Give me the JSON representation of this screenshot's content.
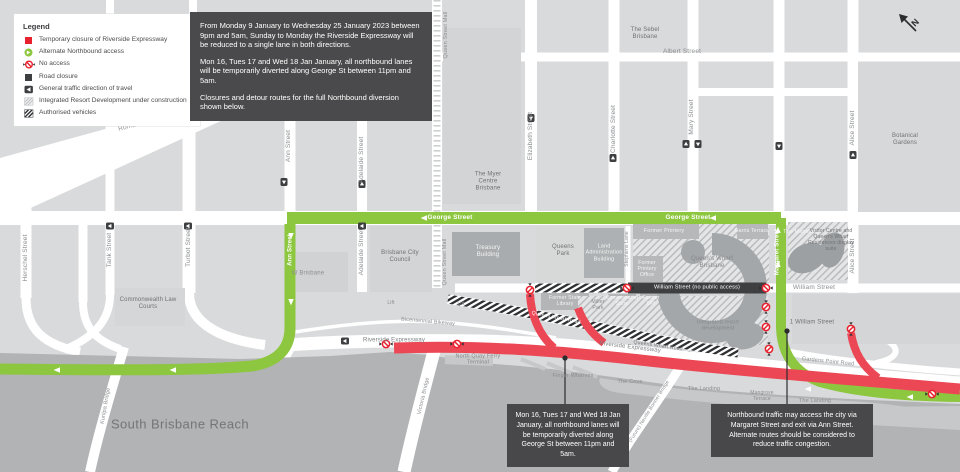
{
  "colors": {
    "closure_red": "#ec4755",
    "detour_green": "#8dc63f",
    "road_closure_dark": "#3e3f41",
    "notice_background": "#4a4a4c",
    "water_gray": "#b1b3b5"
  },
  "legend": {
    "title": "Legend",
    "items": [
      {
        "icon": "red-square-icon",
        "label": "Temporary closure of Riverside Expressway"
      },
      {
        "icon": "green-access-icon",
        "label": "Alternate Northbound access"
      },
      {
        "icon": "no-access-icon",
        "label": "No access"
      },
      {
        "icon": "dark-square-icon",
        "label": "Road closure"
      },
      {
        "icon": "direction-arrow-icon",
        "label": "General traffic direction of travel"
      },
      {
        "icon": "hatched-area-icon",
        "label": "Integrated Resort Development under construction"
      },
      {
        "icon": "hatched-road-icon",
        "label": "Authorised vehicles"
      }
    ]
  },
  "notice": {
    "p1": "From Monday 9 January to Wednesday 25 January 2023 between 9pm and 5am, Sunday to Monday the Riverside Expressway will be reduced to a single lane in both directions.",
    "p2": "Mon 16, Tues 17 and Wed 18 Jan January, all northbound lanes will be temporarily diverted along George St between 11pm and 5am.",
    "p3": "Closures and detour routes for the full Northbound diversion shown below."
  },
  "callouts": {
    "george": "Mon 16, Tues 17 and Wed 18 Jan January, all northbound lanes will be temporarily diverted along George St between 11pm and 5am.",
    "margaret": "Northbound traffic may access the city via Margaret Street and exit via Ann Street. Alternate routes should be considered to reduce traffic congestion."
  },
  "compass": {
    "label": "N"
  },
  "map": {
    "labels": {
      "roma_street": "Roma Street",
      "herschel_street": "Herschel Street",
      "tank_street": "Tank Street",
      "turbot_street": "Turbot Street",
      "ann_street": "Ann Street",
      "adelaide_street": "Adelaide Street",
      "queen_street_mall": "Queen Street Mall",
      "elizabeth_street": "Elizabeth Street",
      "charlotte_street": "Charlotte Street",
      "mary_street": "Mary Street",
      "albert_street": "Albert Street",
      "alice_street": "Alice Street",
      "margaret_street": "Margaret Street",
      "george_street": "George Street",
      "william_street_closed": "William Street (no public access)",
      "william_street": "William Street",
      "stephens_lane": "Stephens Lane",
      "queens_wharf_road": "Queens Wharf Road",
      "riverside_expressway": "Riverside Expressway",
      "bicentennial_bikeway": "Bicentennial Bikeway",
      "lift": "Lift",
      "victoria_bridge": "Victoria Bridge",
      "kurilpa_bridge": "Kurilpa Bridge",
      "neville_bonner_bridge": "(Future) Neville Bonner Bridge",
      "south_brisbane_reach": "South Brisbane Reach",
      "commonwealth_law_courts": "Commonwealth Law Courts",
      "w_brisbane": "W Brisbane",
      "brisbane_city_council": "Brisbane City Council",
      "treasury_building": "Treasury Building",
      "myer_centre": "The Myer Centre Brisbane",
      "sebel_brisbane": "The Sebel Brisbane",
      "queens_park": "Queens Park",
      "land_administration": "Land Administration Building",
      "former_printery": "Former Printery",
      "former_printery_office": "Former Printery Office",
      "harris_terrace": "Harris Terrace",
      "queens_wharf_brisbane": "Queen's Wharf Brisbane",
      "the_mansions": "The Mansions",
      "visitor_centre": "Visitor Centre and Queen's Wharf Residences display suite",
      "botanical_gardens": "Botanical Gardens",
      "former_state_library": "Former State Library",
      "miller_park": "Miller Park",
      "commissariat_store": "Commissariat Store",
      "former_dpi": "Former DPI",
      "integrated_resort": "Integrated resort development",
      "north_quay_ferry_terminal": "North Quay Ferry Terminal",
      "finger_wharves": "Finger Wharves",
      "the_cove": "The Cove",
      "the_landing": "The Landing",
      "mangrove_terrace": "Mangrove Terrace",
      "gardens_point_road": "Gardens Point Road",
      "one_william_street": "1 William Street"
    }
  }
}
